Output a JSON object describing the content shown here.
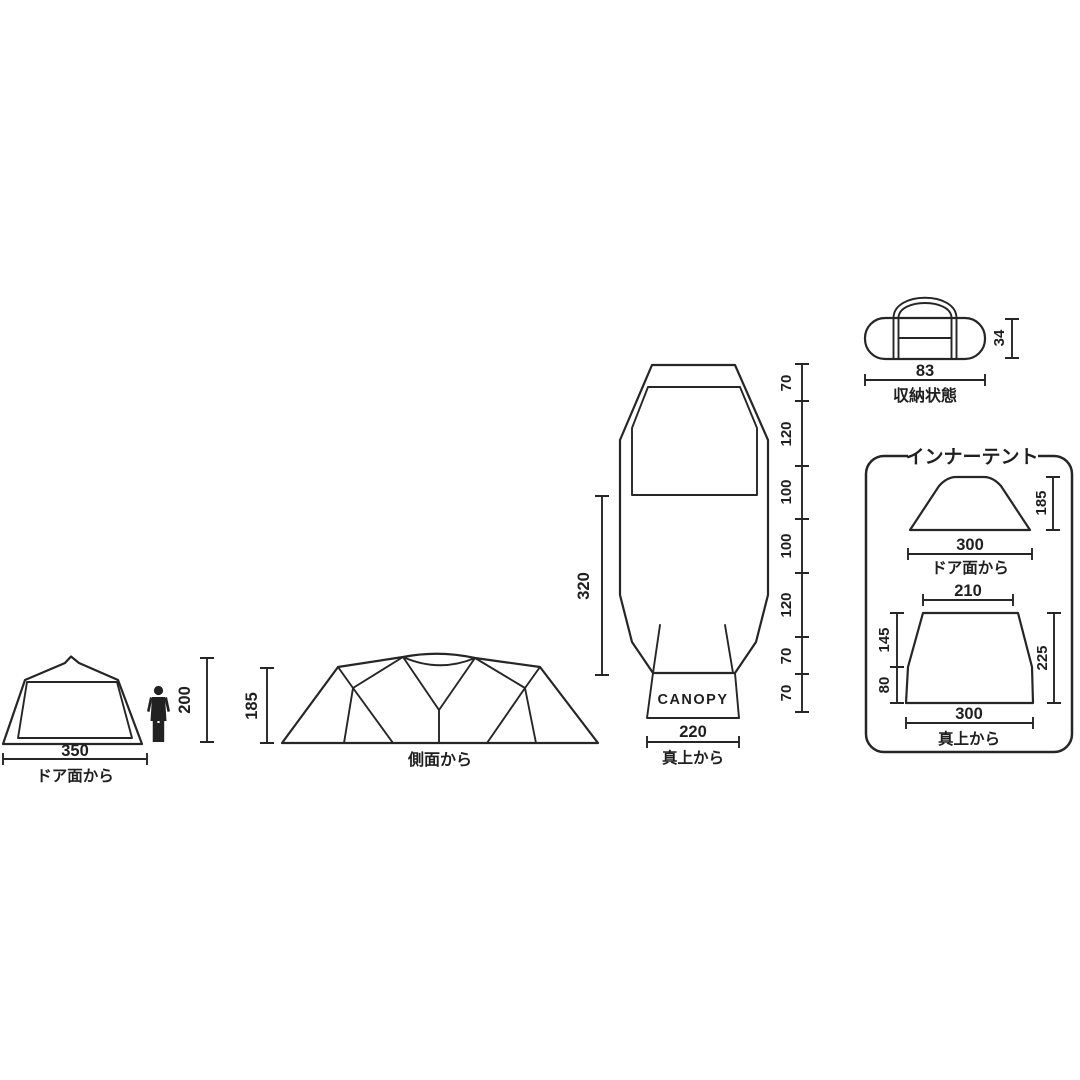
{
  "colors": {
    "line": "#262626",
    "background": "#ffffff",
    "text": "#1f1f1f"
  },
  "views": {
    "front": {
      "label": "ドア面から",
      "width_value": "350",
      "person_height_value": "200"
    },
    "side": {
      "label": "側面から",
      "height_value": "185"
    },
    "top": {
      "label": "真上から",
      "canopy_label": "CANOPY",
      "bottom_width_value": "220",
      "inner_length_value": "320",
      "segments": [
        "70",
        "120",
        "100",
        "100",
        "120",
        "70",
        "70"
      ]
    },
    "packed": {
      "label": "収納状態",
      "width_value": "83",
      "height_value": "34"
    },
    "inner_tent": {
      "title": "インナーテント",
      "front": {
        "label": "ドア面から",
        "width_value": "300",
        "height_value": "185"
      },
      "top": {
        "label": "真上から",
        "top_width_value": "210",
        "bottom_width_value": "300",
        "upper_depth_value": "145",
        "lower_depth_value": "80",
        "total_depth_value": "225"
      }
    }
  }
}
